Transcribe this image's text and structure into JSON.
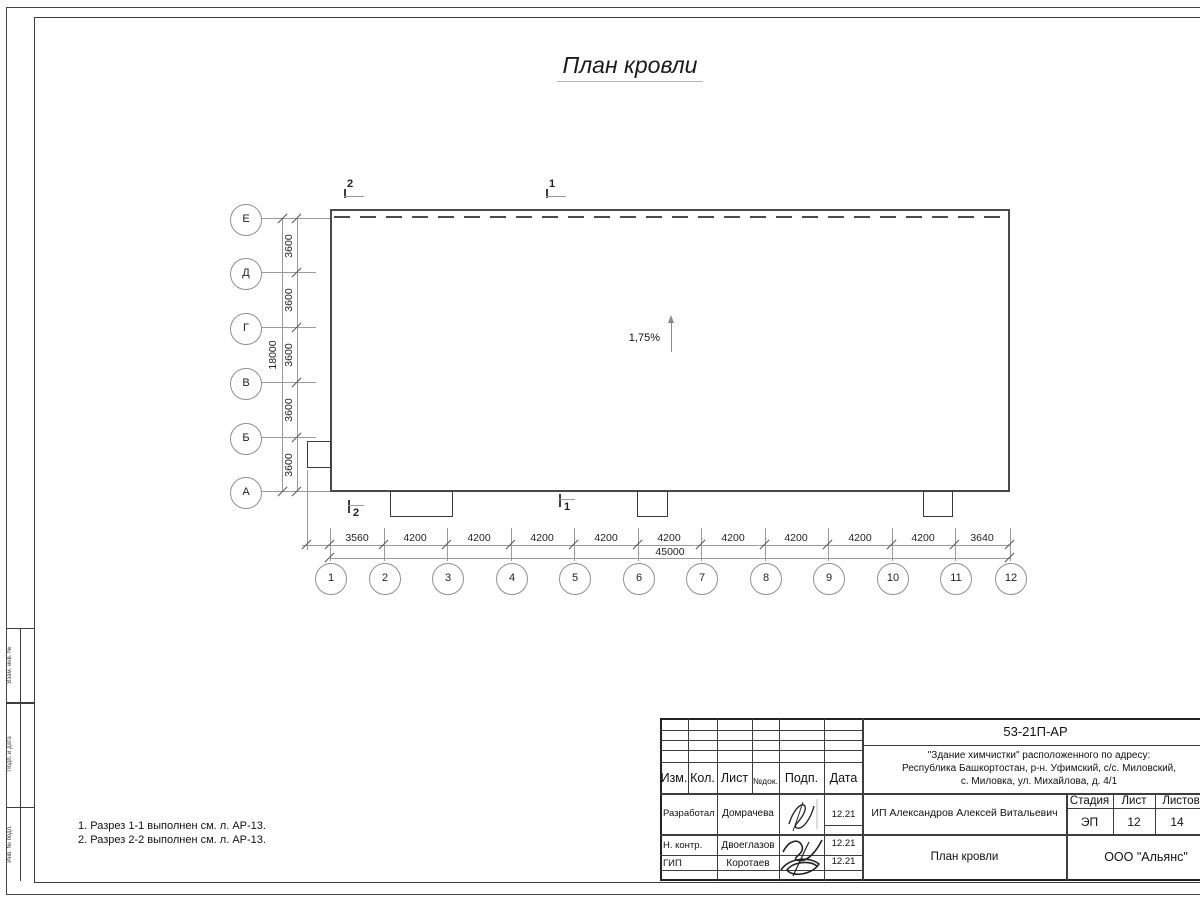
{
  "page_title": "План кровли",
  "plan": {
    "slope": "1,75%",
    "row_axes": [
      "Е",
      "Д",
      "Г",
      "В",
      "Б",
      "А"
    ],
    "col_axes": [
      "1",
      "2",
      "3",
      "4",
      "5",
      "6",
      "7",
      "8",
      "9",
      "10",
      "11",
      "12"
    ],
    "v_dims": [
      "3600",
      "3600",
      "3600",
      "3600",
      "3600"
    ],
    "v_total": "18000",
    "h_dims": [
      "3560",
      "4200",
      "4200",
      "4200",
      "4200",
      "4200",
      "4200",
      "4200",
      "4200",
      "4200",
      "3640"
    ],
    "h_total": "45000",
    "sections": {
      "s2_top": "2",
      "s1_top": "1",
      "s2_bottom": "2",
      "s1_bottom": "1"
    }
  },
  "notes": {
    "line1": "1. Разрез 1-1 выполнен см. л. АР-13.",
    "line2": "2. Разрез 2-2 выполнен см. л. АР-13."
  },
  "side_strip": {
    "cell1": "Взам. инв. №",
    "cell2": "Подп. и дата",
    "cell3": "Инв. № подл."
  },
  "stamp": {
    "doc": "53-21П-АР",
    "addr1": "\"Здание химчистки\" расположенного по адресу:",
    "addr2": "Республика Башкортостан, р-н. Уфимский, с/с. Миловский,",
    "addr3": "с. Миловка, ул. Михайлова, д. 4/1",
    "col_izm": "Изм.",
    "col_kol": "Кол.",
    "col_list": "Лист",
    "col_ndok": "№док.",
    "col_podp": "Подп.",
    "col_data": "Дата",
    "r1_role": "Разработал",
    "r1_name": "Домрачева",
    "r1_date": "12.21",
    "r2_role": "Н. контр.",
    "r2_name": "Двоеглазов",
    "r2_date": "12.21",
    "r3_role": "ГИП",
    "r3_name": "Коротаев",
    "r3_date": "12.21",
    "client": "ИП Александров Алексей Витальевич",
    "stage_h": "Стадия",
    "list_h": "Лист",
    "listov_h": "Листов",
    "stage": "ЭП",
    "list": "12",
    "listov": "14",
    "dwg": "План кровли",
    "org": "ООО \"Альянс\""
  }
}
